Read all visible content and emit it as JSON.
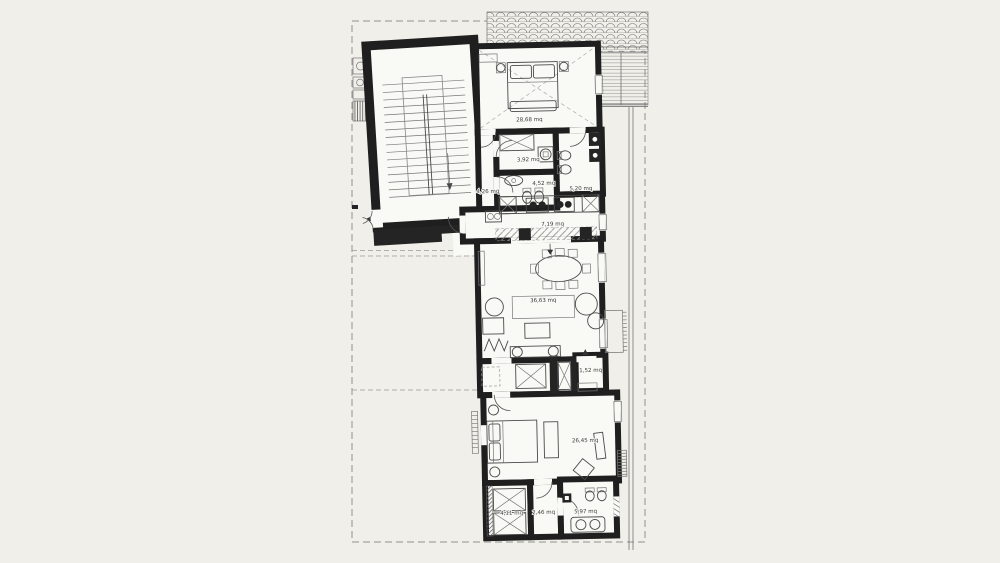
{
  "page": {
    "background_color": "#f0efe9",
    "floor_color": "#f9f9f6",
    "wall_color": "#1f1f1f",
    "line_color": "#4a4a4a",
    "boundary_color": "#909090"
  },
  "plan": {
    "type": "architectural-floor-plan",
    "unit": "mq",
    "rooms": [
      {
        "id": "bedroom-main",
        "area_label": "28,68 mq"
      },
      {
        "id": "bathroom-wardrobe",
        "area_label": "3,92 mq"
      },
      {
        "id": "bathroom-1",
        "area_label": "4,52 mq"
      },
      {
        "id": "bathroom-2",
        "area_label": "5,20 mq"
      },
      {
        "id": "hallway",
        "area_label": "4,26 mq"
      },
      {
        "id": "kitchen",
        "area_label": "7,19 mq"
      },
      {
        "id": "living-room",
        "area_label": "36,63 mq"
      },
      {
        "id": "closet",
        "area_label": "1,52 mq"
      },
      {
        "id": "bedroom-2",
        "area_label": "26,45 mq"
      },
      {
        "id": "wardrobe-2",
        "area_label": "4,11 mq"
      },
      {
        "id": "corridor",
        "area_label": "2,46 mq"
      },
      {
        "id": "bathroom-3",
        "area_label": "5,97 mq"
      }
    ]
  }
}
